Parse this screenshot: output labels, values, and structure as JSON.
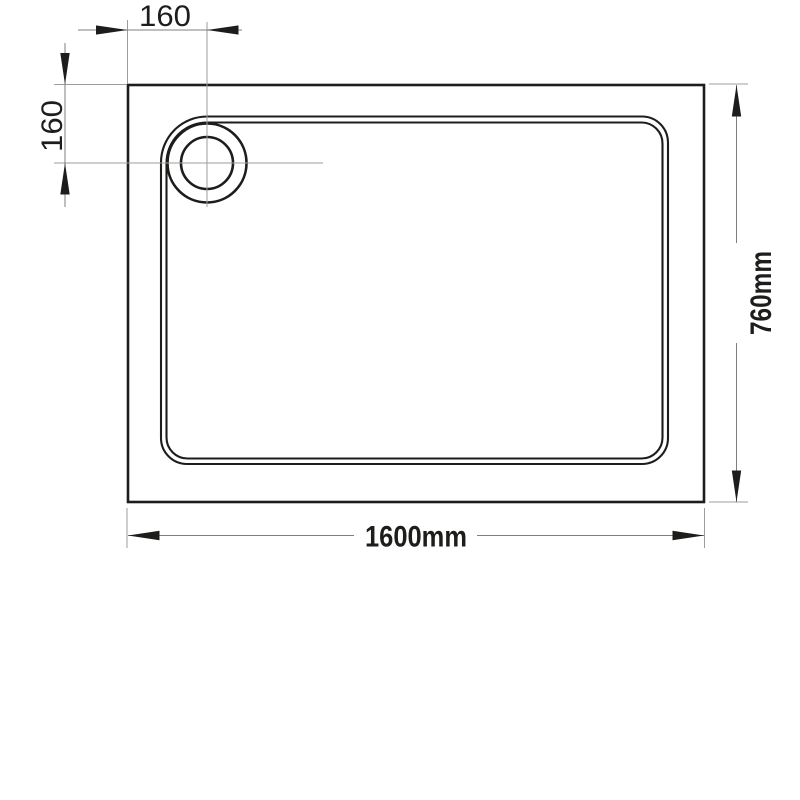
{
  "drawing": {
    "labels": {
      "drain_offset_horizontal": "160",
      "drain_offset_vertical": "160",
      "overall_width": "1600mm",
      "overall_depth": "760mm"
    },
    "colors": {
      "outline": "#1d1d1b",
      "dimension_line": "#7f7f7f",
      "extension_line": "#9d9d9d",
      "label_text": "#1d1d1b",
      "background": "#ffffff"
    },
    "icons": {
      "arrowhead": "filled-triangle"
    }
  }
}
